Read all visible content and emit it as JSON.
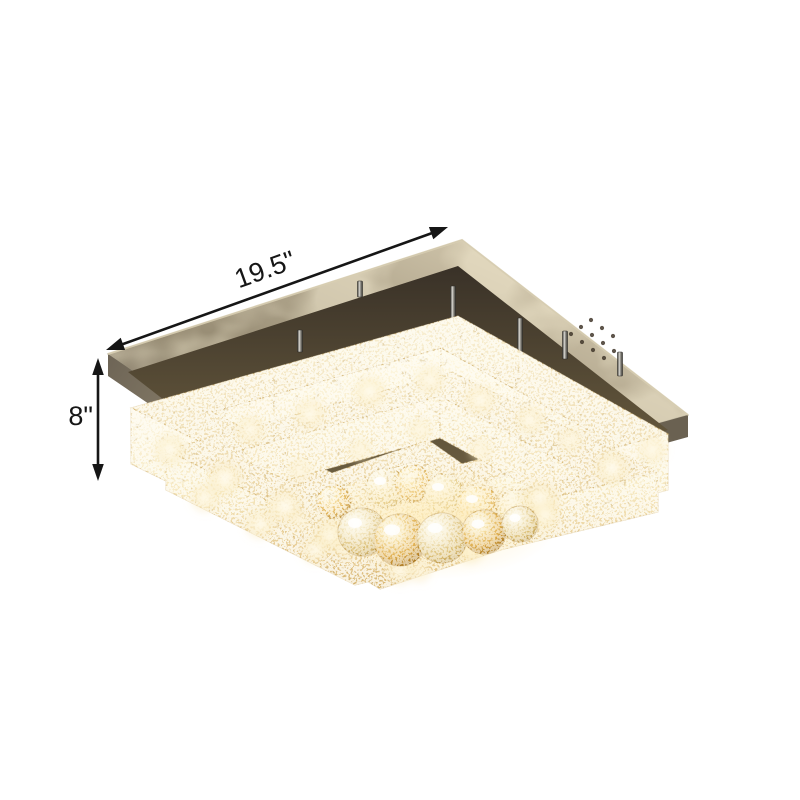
{
  "scene": {
    "background_color": "#ffffff",
    "alt": "Square two-tier crystal LED flush mount ceiling light with chrome canopy and amber crystal ball drops, shown with dimension arrows"
  },
  "dimension_annotations": {
    "width_label": "19.5\"",
    "height_label": "8\""
  },
  "palette": {
    "annotation_color": "#161616",
    "canopy_chrome": "#a89d85",
    "canopy_light": "#cdc2a8",
    "crystal_bright": "#fdf8e8",
    "crystal_warm": "#f6e8c0",
    "crystal_deep": "#d2ad66",
    "ball_amber": "#dfae4e",
    "glow": "#fff6d9",
    "dark_mirror": "#4e4437"
  }
}
